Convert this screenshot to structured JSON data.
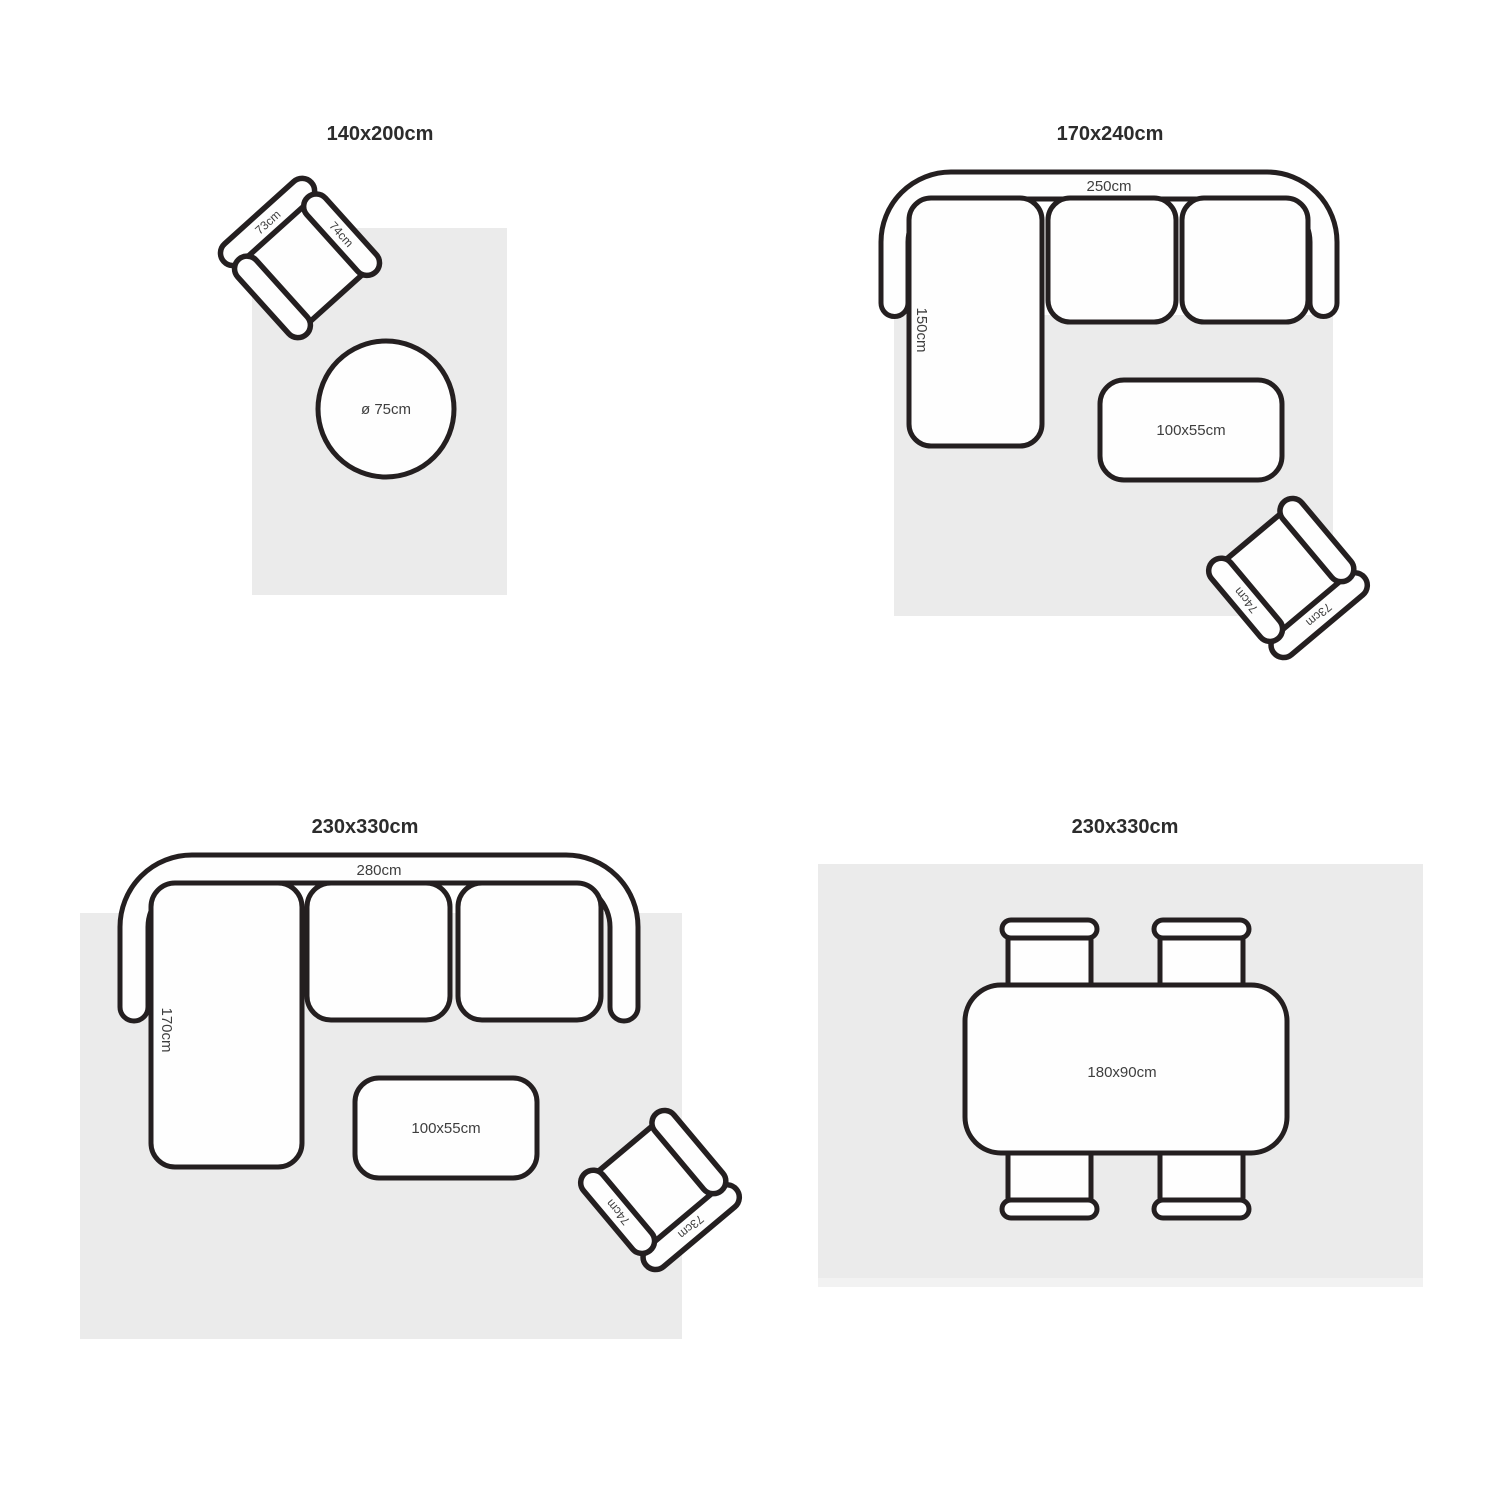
{
  "colors": {
    "rug": "#ebebeb",
    "fringe": "#f2f2f2",
    "stroke": "#241f20",
    "fill": "#fefefe",
    "label": "#3e3e3e",
    "title": "#2c2c2c"
  },
  "panels": {
    "p1": {
      "title": "140x200cm",
      "chair": {
        "back_label": "73cm",
        "arm_label": "74cm"
      },
      "round_table": {
        "label": "ø 75cm"
      }
    },
    "p2": {
      "title": "170x240cm",
      "sofa": {
        "width_label": "250cm",
        "depth_label": "150cm"
      },
      "coffee_table": {
        "label": "100x55cm"
      },
      "chair": {
        "back_label": "73cm",
        "arm_label": "74cm"
      }
    },
    "p3": {
      "title": "230x330cm",
      "sofa": {
        "width_label": "280cm",
        "depth_label": "170cm"
      },
      "coffee_table": {
        "label": "100x55cm"
      },
      "chair": {
        "back_label": "73cm",
        "arm_label": "74cm"
      }
    },
    "p4": {
      "title": "230x330cm",
      "dining_table": {
        "label": "180x90cm"
      }
    }
  }
}
